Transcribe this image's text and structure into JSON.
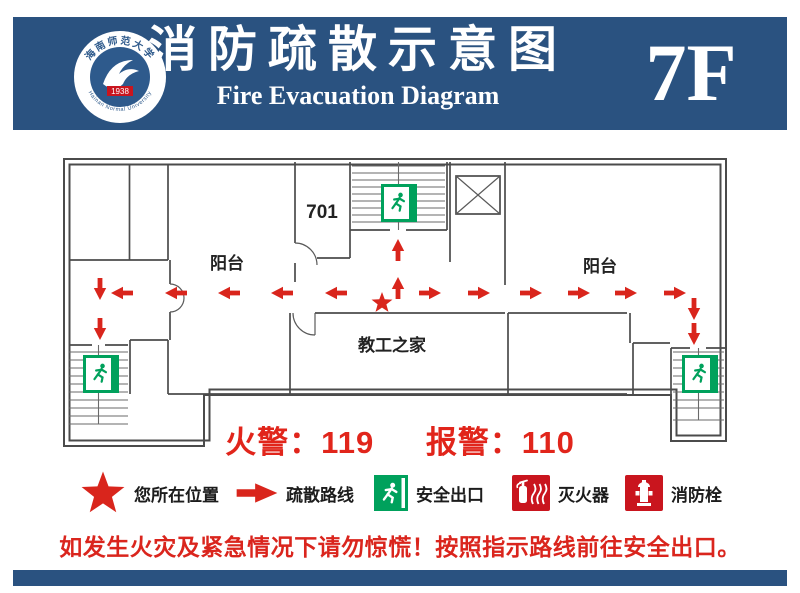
{
  "colors": {
    "header_blue": "#2A5280",
    "route_red": "#D9251C",
    "legend_red": "#C9151E",
    "exit_green": "#00A15C",
    "wall_gray": "#4B4B4B",
    "warning_red": "#DA251D"
  },
  "header": {
    "title": "消防疏散示意图",
    "subtitle": "Fire Evacuation Diagram",
    "floor": "7F",
    "logo": {
      "name_zh": "海南师范大学",
      "name_en": "Hainan Normal University",
      "year": "1938"
    }
  },
  "plan": {
    "room_701": "701",
    "balcony_left": "阳台",
    "balcony_right": "阳台",
    "staff_home": "教工之家"
  },
  "emergency": {
    "fire": "火警：119",
    "police": "报警：110"
  },
  "legend": {
    "items": [
      {
        "icon": "location-star-icon",
        "label": "您所在位置"
      },
      {
        "icon": "route-arrow-icon",
        "label": "疏散路线"
      },
      {
        "icon": "exit-sign-icon",
        "label": "安全出口"
      },
      {
        "icon": "fire-extinguisher-icon",
        "label": "灭火器"
      },
      {
        "icon": "fire-hydrant-icon",
        "label": "消防栓"
      }
    ]
  },
  "warning": "如发生火灾及紧急情况下请勿惊慌！按照指示路线前往安全出口。"
}
